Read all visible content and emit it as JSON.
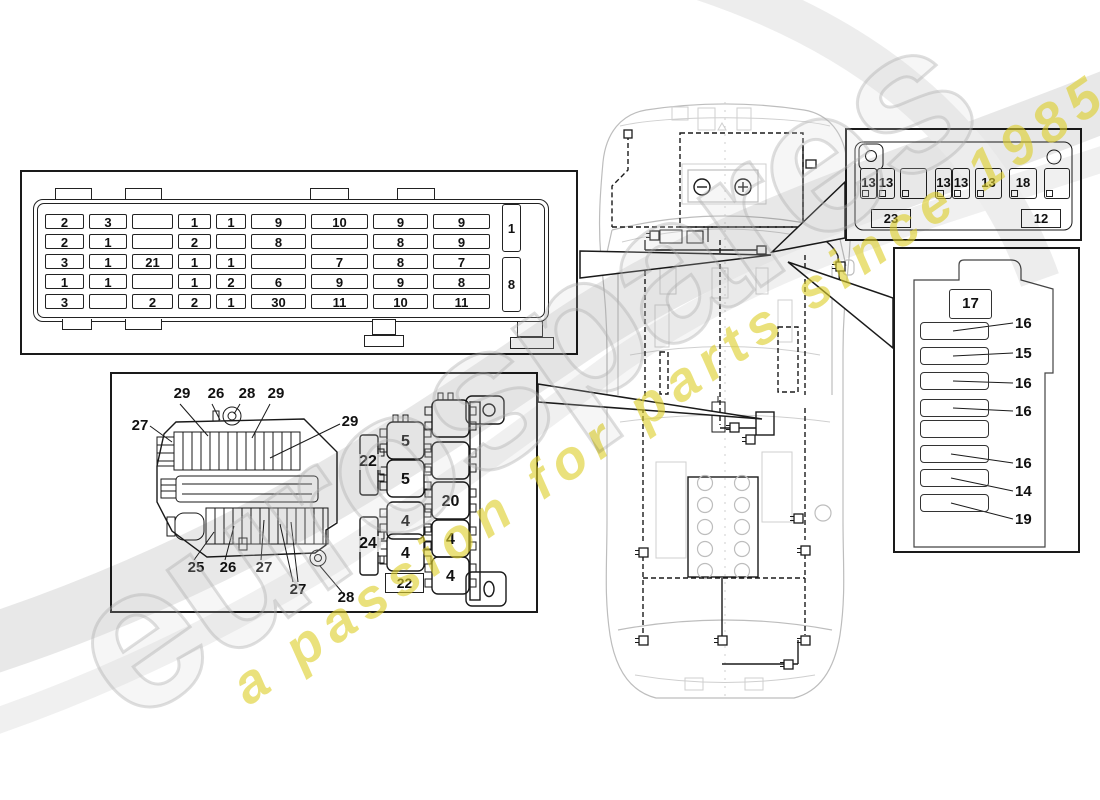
{
  "watermark": {
    "brand": "eurospares",
    "tagline": "a passion for parts since 1985",
    "brand_color": "#c8c8c8",
    "tagline_color": "#ddcf2b"
  },
  "main_fuse_box": {
    "rows": [
      [
        "2",
        "3",
        "",
        "1",
        "1",
        "9",
        "10",
        "9",
        "9"
      ],
      [
        "2",
        "1",
        "",
        "2",
        "",
        "8",
        "",
        "8",
        "9"
      ],
      [
        "3",
        "1",
        "21",
        "1",
        "1",
        "",
        "7",
        "8",
        "7"
      ],
      [
        "1",
        "1",
        "",
        "1",
        "2",
        "6",
        "9",
        "9",
        "8"
      ],
      [
        "3",
        "",
        "2",
        "2",
        "1",
        "30",
        "11",
        "10",
        "11"
      ]
    ],
    "side_cells": [
      "1",
      "8"
    ]
  },
  "relay_panel": {
    "carrier_callouts": [
      "27",
      "29",
      "26",
      "28",
      "29",
      "29",
      "25",
      "26",
      "27",
      "27",
      "28"
    ],
    "relay_labels_left": [
      "5",
      "5",
      "4",
      "4"
    ],
    "relay_labels_right": [
      "",
      "",
      "20",
      "4",
      "4"
    ],
    "side_labels": [
      "22",
      "24"
    ],
    "bottom_label": "22"
  },
  "small_relay_box": {
    "slots": [
      "13",
      "13",
      "",
      "13",
      "13",
      "13",
      "18",
      ""
    ],
    "bottom_labels": [
      "23",
      "12"
    ]
  },
  "trunk_fuse_panel": {
    "top_label": "17",
    "slot_labels": [
      "16",
      "15",
      "16",
      "16",
      "",
      "16",
      "14",
      "19"
    ]
  },
  "line_color": "#1a1a1a",
  "car_outline_color": "#bdbdbd"
}
